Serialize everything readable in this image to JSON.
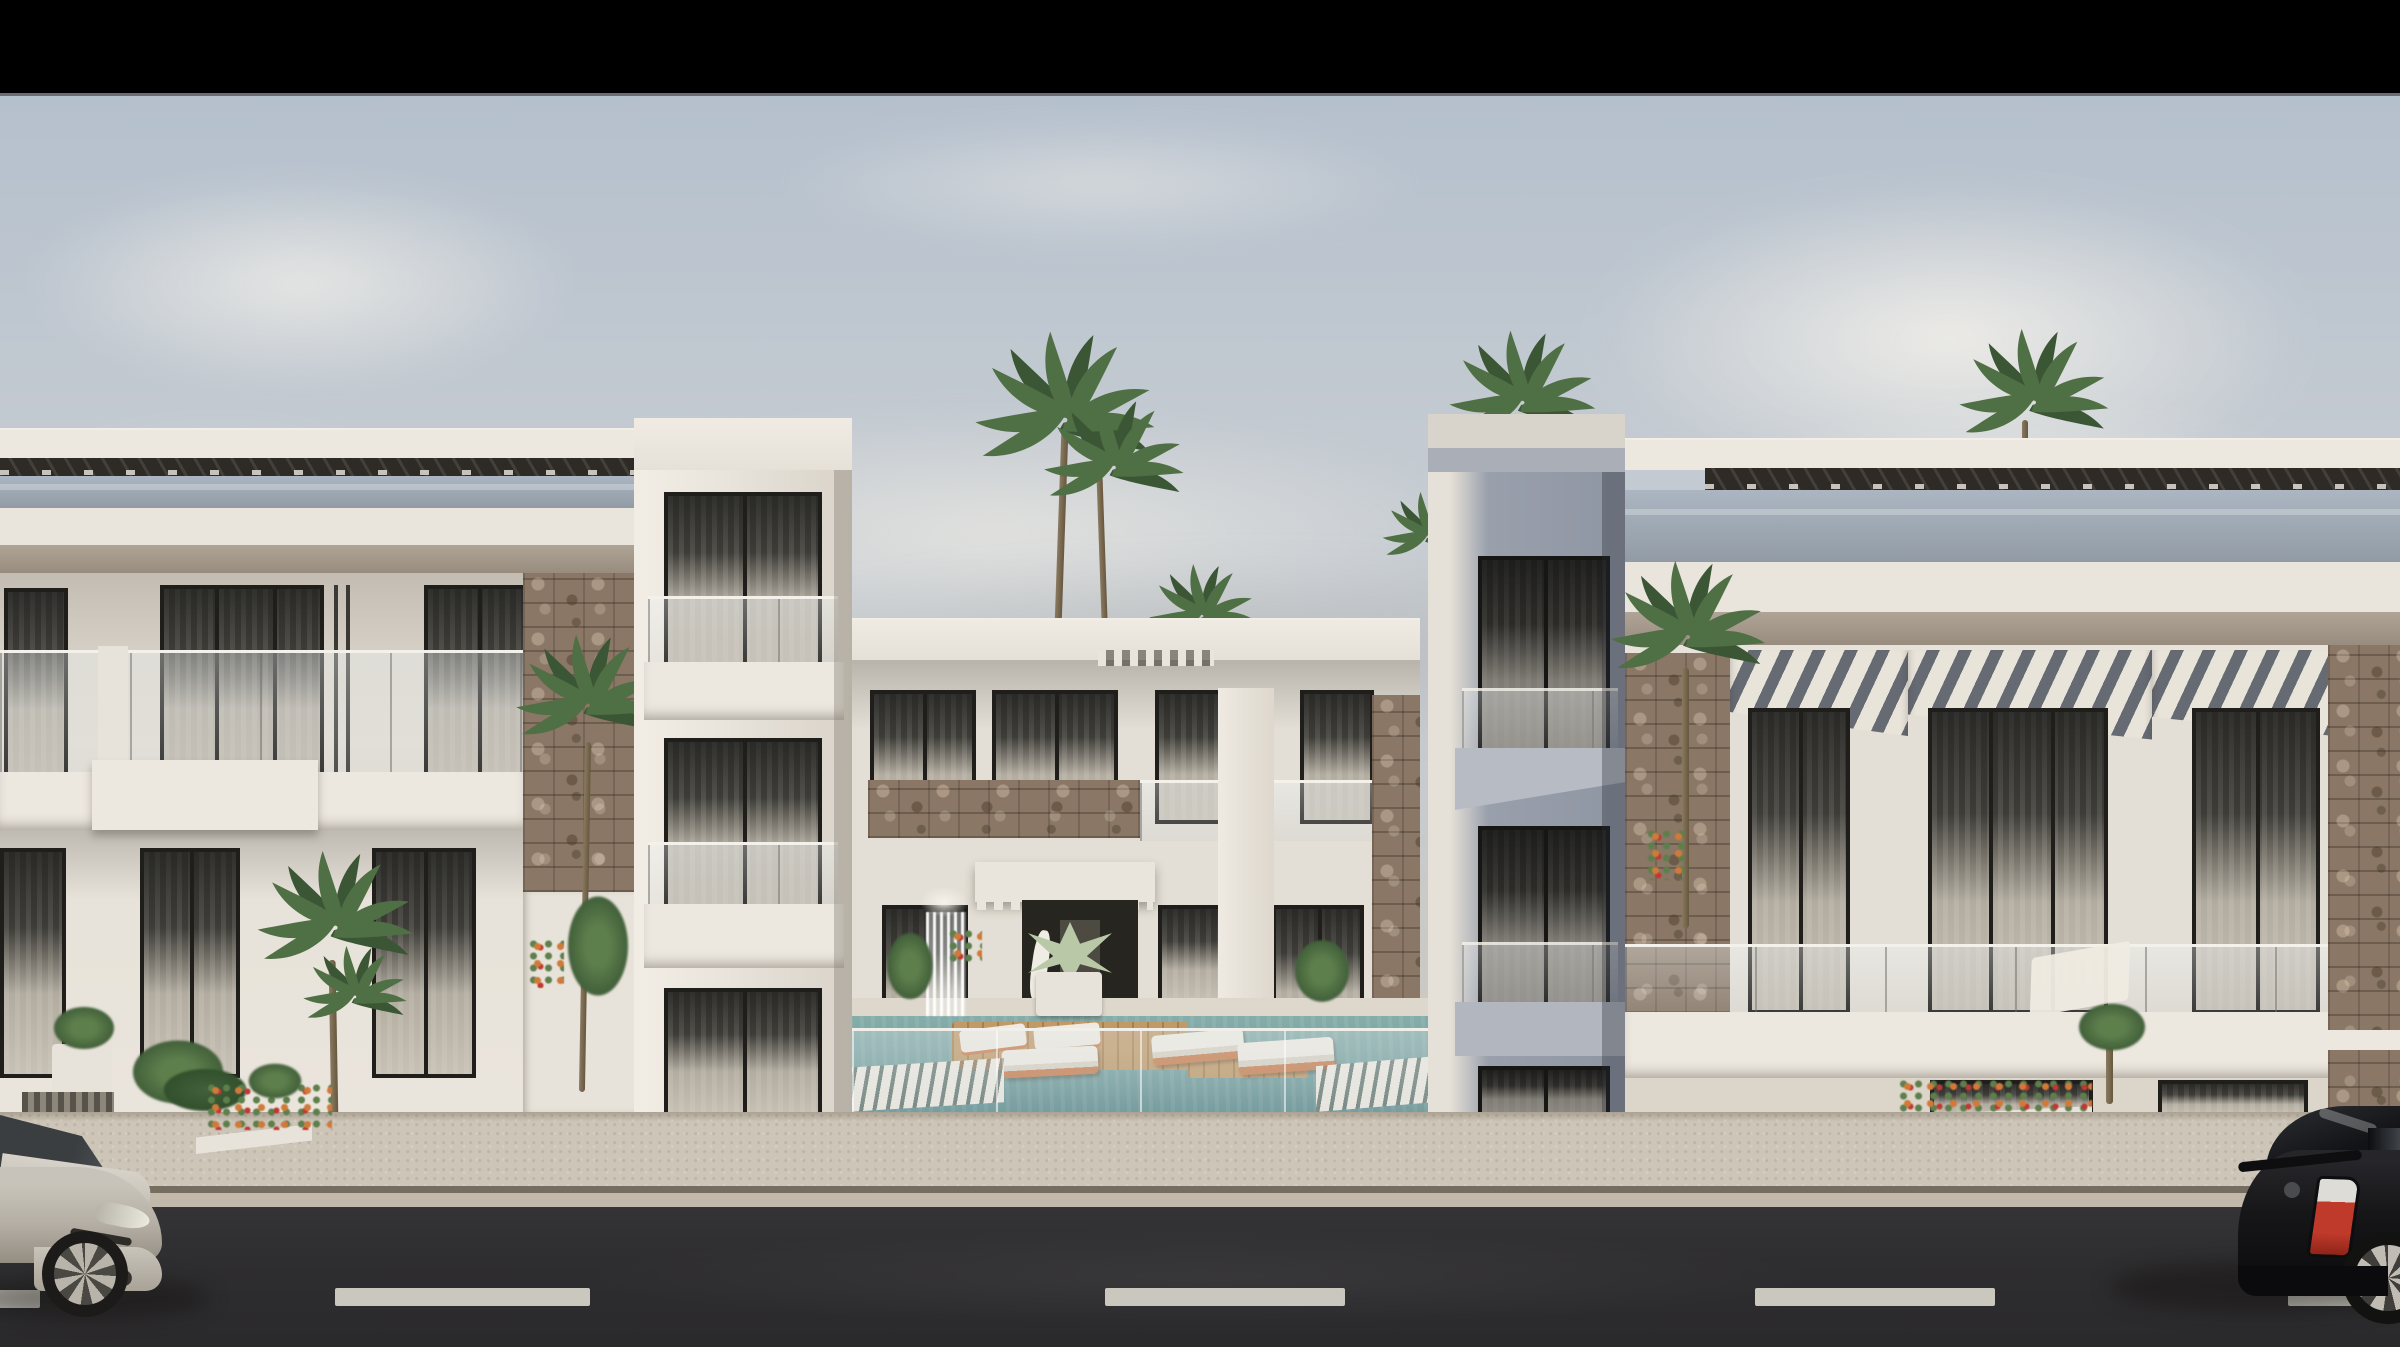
{
  "meta": {
    "kind": "architectural-exterior-render",
    "width_px": 2400,
    "height_px": 1347
  },
  "scene": {
    "description": "Photorealistic 3D rendering of a modern white three-storey apartment complex. A black letterbox bar runs across the top. Hazy grey-blue sky with large soft clouds. Left and right building wings have rooftop slat pergolas over glass bands, tan soffits, dark-framed glass doors with sheer curtains and glass balustrades; the right wing adds grey-striped awnings and stone-clad columns. A recessed centre building with a dentilled entrance canopy faces a courtyard with a teal swimming pool, wooden deck islands, white and orange sun loungers, a small waterfall feature and tropical planters behind a glass pool fence. Palm trees rise above the rooflines. In front: a pale concrete sidewalk with white flower planters, then an asphalt road with dashed white lane markings. A silver hatchback enters at the left edge and a black hatchback at the right edge.",
    "objects": [
      "letterbox-bar",
      "sky",
      "clouds",
      "palm-trees",
      "left-building",
      "left-stair-tower",
      "center-building",
      "entrance-canopy",
      "entrance-door",
      "swimming-pool",
      "pool-deck",
      "sun-loungers",
      "waterfall-feature",
      "glass-pool-fence",
      "shadow-tower",
      "right-building",
      "striped-awnings",
      "stone-cladding",
      "balcony-glass-railings",
      "rooftop-pergolas",
      "planters",
      "flower-beds",
      "sidewalk",
      "curb",
      "road",
      "lane-markings",
      "silver-car",
      "black-car"
    ],
    "counts": {
      "rooftop_palm_clusters": 3,
      "courtyard_palms": 3,
      "cars": 2,
      "lane_dashes": 5,
      "awning_sections": 3,
      "building_storeys": 3
    }
  },
  "colors": {
    "black_bar": "#000000",
    "sky_top": "#b5c0cd",
    "sky_mid": "#c6ccd2",
    "sky_horizon": "#cbc9c3",
    "cloud": "#f0eee9",
    "cloud_shade": "#b7b5b1",
    "facade": "#e4dfd6",
    "facade_lit": "#efeae1",
    "facade_shadow": "#b9b3aa",
    "white_wall": "#e8e3da",
    "parapet": "#ece7df",
    "fascia": "#e9e4dc",
    "pergola": "#2e2a25",
    "pergola_tick": "#d8d4cb",
    "glass_top": "#abb6c2",
    "glass_bottom": "#929ba5",
    "soffit_top": "#b0a496",
    "soffit_bottom": "#988c7e",
    "tower_face": "#99a0ac",
    "tower_cap": "#d9d4cb",
    "tower_shade": "#868d99",
    "tower_lit": "#e6e1d8",
    "window_frame": "#1f1e1b",
    "window_base": "#35342f",
    "curtain_light": "#d2cbbf",
    "stone": "#8a7765",
    "stone_dark": "#5f5244",
    "stone_light": "#a58e74",
    "awning_light": "#e9e4da",
    "awning_dark": "#666a72",
    "pool_top": "#85adaa",
    "pool": "#78a2a1",
    "pool_deep": "#5d8d90",
    "deck": "#c19a68",
    "deck_line": "#7a5a31",
    "lounger_white": "#efebe2",
    "lounger_orange": "#c97c4c",
    "rail_white": "#f4f1ea",
    "ledge": "#ddd7cc",
    "sidewalk": "#cdc5b7",
    "curb_dark": "#756d60",
    "curb_light": "#c2b9ab",
    "road": "#2e2d2f",
    "road_light": "#3a393c",
    "lane": "#d6d3ca",
    "car_silver": "#c8c3ba",
    "car_silver_dark": "#938d82",
    "car_black": "#161618",
    "glass_dark": "#23262a",
    "taillight_red": "#bf3a2b",
    "taillight_white": "#dddcd6",
    "palm": "#4f6f45",
    "palm_dark": "#3b5634",
    "trunk_light": "#8a7a60",
    "trunk_dark": "#66573f",
    "foliage": "#42603a",
    "foliage_light": "#5d7f4c",
    "agave": "#b9c9a8",
    "flower_red": "#c03832",
    "flower_orange": "#d07a3a",
    "entrance_dark": "#26251f",
    "shadow": "rgba(20,18,15,0.45)"
  }
}
